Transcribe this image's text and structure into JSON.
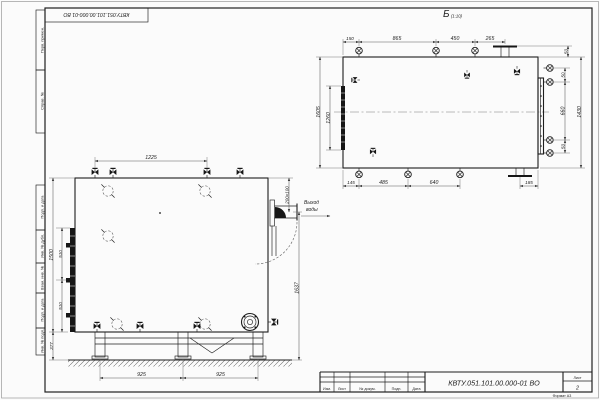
{
  "doc": {
    "number": "КВТУ.051.101.00.000-01  ВО",
    "stamp_number": "КВТУ.051.101.00.000-01 ВО",
    "sheet_label": "Лист",
    "sheet_number": "2",
    "format": "Формат А3"
  },
  "title_block": {
    "cols": [
      "Изм.",
      "Лист",
      "№ докум.",
      "Подп.",
      "Дата"
    ]
  },
  "frame": {
    "margin_labels": [
      "Перв. примен.",
      "Справ. №",
      "Подп. и дата",
      "Инв. № дубл.",
      "Взам. инв. №",
      "Подп. и дата",
      "Инв. № подл."
    ]
  },
  "plan_view": {
    "label": "Б",
    "scale": "(1:10)",
    "dims": {
      "t1": "150",
      "t2": "865",
      "t3": "450",
      "t4": "265",
      "tr": "50",
      "b1": "145",
      "b2": "485",
      "b3": "640",
      "b4": "185",
      "l_outer": "1605",
      "l_inner": "1260",
      "r1": "50",
      "r2": "660",
      "r3": "50",
      "r_outer": "1430"
    }
  },
  "front_view": {
    "dims": {
      "top": "1225",
      "left_outer": "1500",
      "left_c1": "510",
      "left_c2": "510",
      "left_b": "377",
      "bottom1": "925",
      "bottom2": "925",
      "outlet": "200х100",
      "right_tall": "1637"
    },
    "outlet_label_line1": "Выход",
    "outlet_label_line2": "воды"
  }
}
